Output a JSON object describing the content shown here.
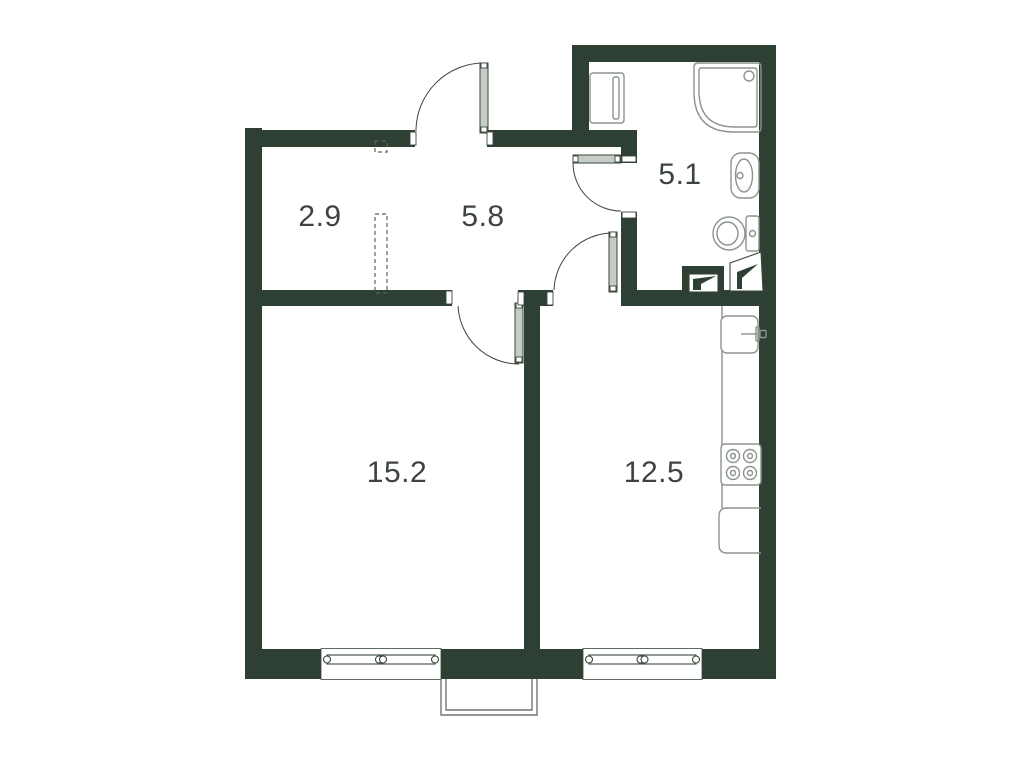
{
  "title": "Apartment floor plan",
  "colors": {
    "wall": "#2e4033",
    "line": "#3a463c",
    "fixture": "#8b938c",
    "leaf": "#c7cdc6",
    "text": "#3b453c",
    "dash": "#57625a",
    "balcony": "#6f776f",
    "background": "#ffffff"
  },
  "rooms": [
    {
      "name": "entry",
      "area": "2.9"
    },
    {
      "name": "hallway",
      "area": "5.8"
    },
    {
      "name": "bathroom",
      "area": "5.1"
    },
    {
      "name": "living-room",
      "area": "15.2"
    },
    {
      "name": "kitchen",
      "area": "12.5"
    }
  ],
  "doors": [
    "entry-door",
    "bathroom-door",
    "living-room-door",
    "kitchen-door"
  ],
  "fixtures": {
    "bathroom": [
      "washing-machine",
      "shower",
      "washbasin",
      "toilet",
      "ventilation-shaft",
      "ventilation-shaft"
    ],
    "kitchen": [
      "kitchen-sink",
      "counter",
      "cooktop-4-burner",
      "kitchen-appliance"
    ],
    "exterior": [
      "window",
      "window",
      "balcony"
    ]
  }
}
